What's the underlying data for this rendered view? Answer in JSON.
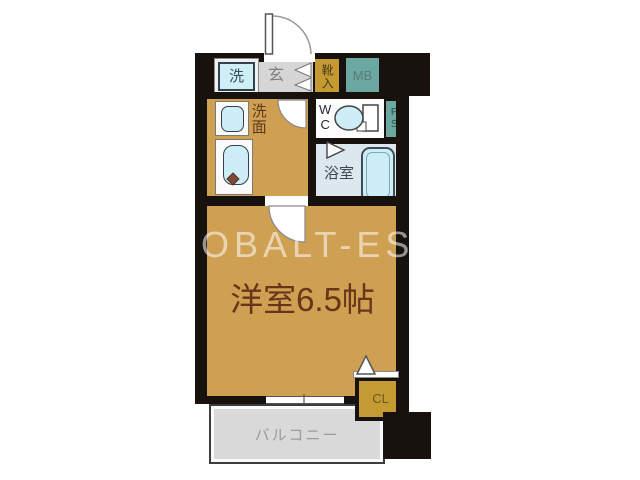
{
  "floorplan": {
    "watermark_text": "COBALT-ESTATE",
    "rooms": {
      "laundry": "洗",
      "entrance": "玄",
      "shoe_storage": "靴入",
      "meter_box": "MB",
      "washroom": "洗面",
      "toilet": "WC",
      "pipe_space": "PS",
      "bathroom": "浴室",
      "main_room": "洋室6.5帖",
      "closet": "CL",
      "balcony": "バルコニー"
    },
    "colors": {
      "floor_tan": "#cfa052",
      "storage_gold": "#c49a33",
      "utility_teal": "#6ba8a1",
      "fixture_cyan": "#cdeef6",
      "bathroom_blue": "#dce8ee",
      "entrance_gray": "#d6d6d6",
      "balcony_gray": "#d9d9d9",
      "wall_black": "#17120e",
      "label_brown": "#68351a"
    }
  }
}
